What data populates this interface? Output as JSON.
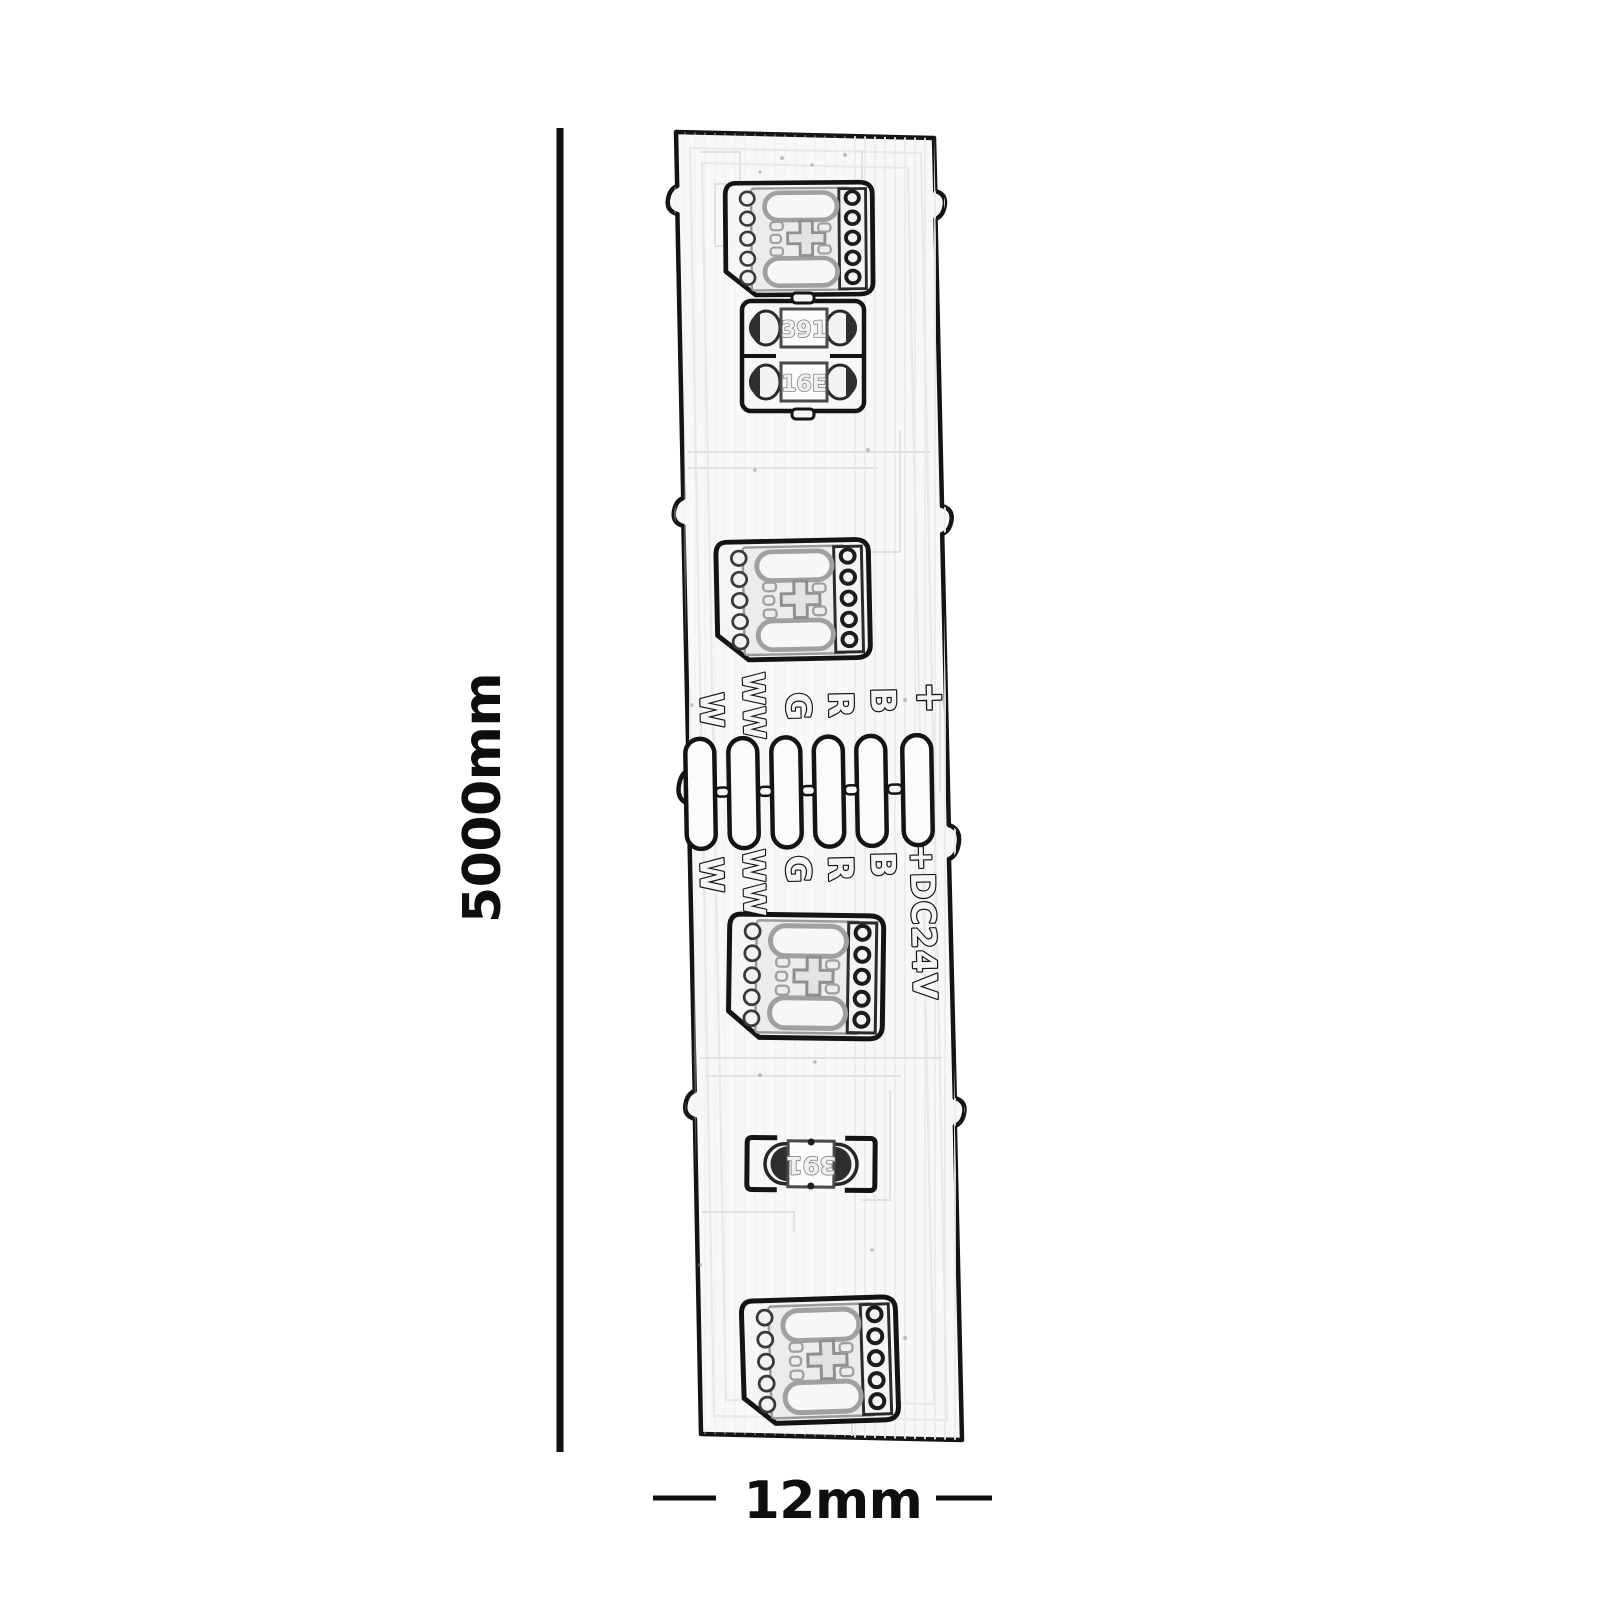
{
  "figure": {
    "kind": "led-strip-dimension-drawing",
    "colors": {
      "line": "#141414",
      "faint_trace": "#e2e2e2",
      "strip_fill": "#f8f8f8",
      "component_gray": "#8f8f8f"
    }
  },
  "dimensions": {
    "height_label": "5000mm",
    "width_label": "12mm"
  },
  "strip": {
    "led_count": 4,
    "pad_count": 6,
    "pad_labels_top": [
      "W",
      "WW",
      "G",
      "R",
      "B",
      "+"
    ],
    "pad_labels_bottom": [
      "W",
      "WW",
      "G",
      "R",
      "B",
      "+DC24V"
    ],
    "resistors": [
      {
        "label": "391"
      },
      {
        "label": "16E"
      },
      {
        "label": "391"
      }
    ]
  }
}
